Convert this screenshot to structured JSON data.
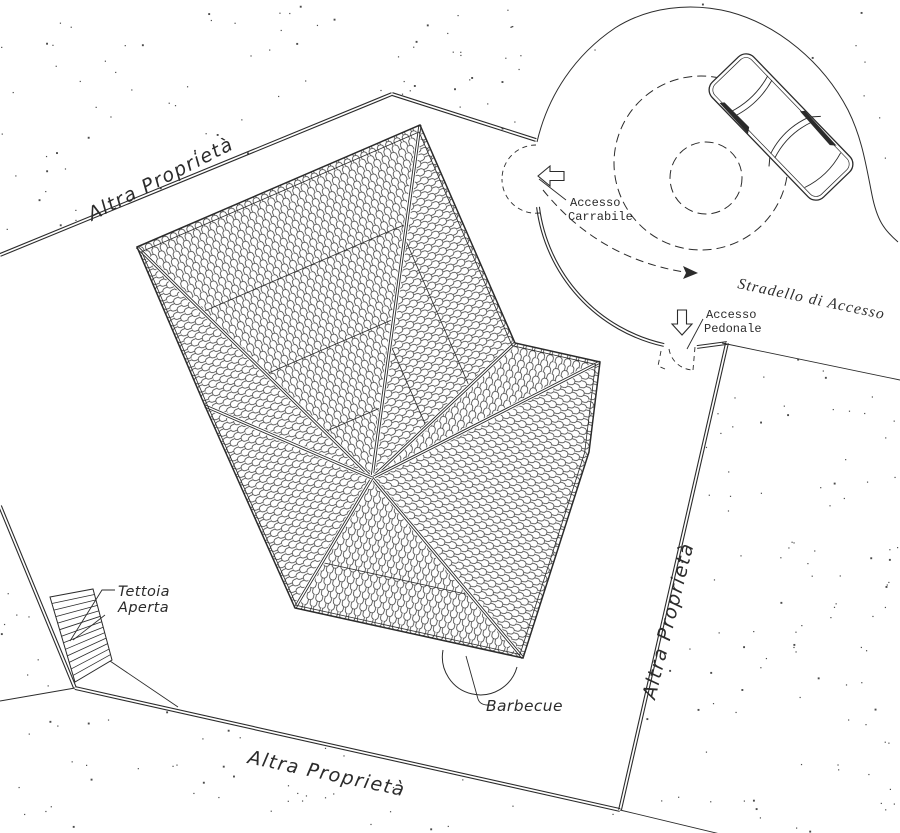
{
  "labels": {
    "altra_top": "Altra Proprietà",
    "altra_right": "Altra Proprietà",
    "altra_bottom": "Altra Proprietà",
    "stradello": "Stradello di Accesso",
    "accesso_carrabile_1": "Accesso",
    "accesso_carrabile_2": "Carrabile",
    "accesso_pedonale_1": "Accesso",
    "accesso_pedonale_2": "Pedonale",
    "tettoia_1": "Tettoia",
    "tettoia_2": "Aperta",
    "barbecue": "Barbecue"
  },
  "colors": {
    "ink": "#2b2b2b",
    "paper": "#ffffff"
  },
  "plan": {
    "roof": {
      "center": [
        372,
        478
      ],
      "outline": [
        [
          137,
          247
        ],
        [
          420,
          125
        ],
        [
          515,
          343
        ],
        [
          600,
          362
        ],
        [
          589,
          452
        ],
        [
          523,
          658
        ],
        [
          295,
          608
        ],
        [
          205,
          406
        ]
      ],
      "faces": [
        {
          "pts": [
            0,
            1
          ],
          "rot": 157
        },
        {
          "pts": [
            1,
            2
          ],
          "rot": 246
        },
        {
          "pts": [
            2,
            3
          ],
          "rot": 193
        },
        {
          "pts": [
            3,
            4,
            5
          ],
          "rot": -75
        },
        {
          "pts": [
            5,
            6
          ],
          "rot": 12
        },
        {
          "pts": [
            6,
            7
          ],
          "rot": 66
        },
        {
          "pts": [
            7,
            0
          ],
          "rot": 67
        }
      ],
      "ridges": [
        0,
        1,
        2,
        3,
        5,
        6,
        7
      ],
      "bands": [
        {
          "f": 0,
          "t": [
            0.28,
            0.55,
            0.8
          ]
        },
        {
          "f": 1,
          "t": [
            0.32,
            0.62
          ]
        },
        {
          "f": 4,
          "t": [
            0.35
          ]
        }
      ]
    },
    "walls": [
      [
        0,
        255,
        392,
        94
      ],
      [
        392,
        94,
        536,
        140
      ],
      [
        697,
        347,
        727,
        343
      ],
      [
        727,
        343,
        620,
        810
      ],
      [
        620,
        810,
        75,
        688
      ],
      [
        75,
        688,
        0,
        506
      ]
    ],
    "wall_arcs": [
      "M 539.4,206.8 A 161,161 0 0 0 664.3,343.6",
      "M 536.6,207.2 A 164,164 0 0 0 663.7,346.4"
    ],
    "thin_lines": [
      [
        722,
        343,
        900,
        380
      ],
      [
        620,
        810,
        762,
        844
      ],
      [
        0,
        701,
        75,
        688
      ],
      [
        110,
        661,
        178,
        707
      ]
    ],
    "drive": {
      "outer": "M 537,142 C 548,95 575,55 615,28 C 648,7 690,2 730,12 C 778,25 823,62 848,110 C 862,138 866,165 872,195 C 877,220 884,230 898,242",
      "circles": [
        [
          701,
          163,
          87
        ],
        [
          706,
          178,
          36
        ]
      ],
      "path_arc": "M 543,190 Q 598,258 684,272",
      "arrow_head": [
        [
          698,
          273
        ],
        [
          683,
          266
        ],
        [
          686,
          273
        ],
        [
          683,
          279
        ]
      ]
    },
    "car": {
      "x": 781,
      "y": 127,
      "rot": 46
    },
    "tettoia": {
      "quad": [
        [
          50,
          597
        ],
        [
          93,
          589
        ],
        [
          112,
          660
        ],
        [
          75,
          682
        ]
      ],
      "hatch_count": 12,
      "diag": [
        73,
        640,
        105,
        615
      ]
    },
    "barbecue_arc": "M 443,650 A 38,38 0 0 0 517,667",
    "gates": [
      "M 536,145 A 34,34 0 0 0 502,179",
      "M 540,213 A 34,34 0 0 1 502,179",
      "M 669,349 A 25,25 0 0 0 693,370",
      "M 693,370 L 695,347",
      "M 661,351 L 658,366 L 665,369"
    ],
    "dots": {
      "seed": 123457,
      "attempts": 700,
      "exclude": [
        [
          [
            0,
            255
          ],
          [
            392,
            94
          ],
          [
            536,
            140
          ],
          [
            543,
            218
          ],
          [
            558,
            263
          ],
          [
            585,
            303
          ],
          [
            622,
            332
          ],
          [
            665,
            345
          ],
          [
            727,
            343
          ],
          [
            620,
            810
          ],
          [
            75,
            688
          ],
          [
            0,
            506
          ]
        ],
        [
          [
            537,
            142
          ],
          [
            560,
            100
          ],
          [
            598,
            48
          ],
          [
            648,
            16
          ],
          [
            705,
            8
          ],
          [
            758,
            24
          ],
          [
            818,
            68
          ],
          [
            850,
            112
          ],
          [
            866,
            160
          ],
          [
            880,
            215
          ],
          [
            898,
            242
          ],
          [
            900,
            242
          ],
          [
            900,
            378
          ],
          [
            727,
            341
          ],
          [
            665,
            345
          ],
          [
            622,
            332
          ],
          [
            585,
            303
          ],
          [
            558,
            263
          ],
          [
            543,
            218
          ]
        ]
      ]
    }
  }
}
